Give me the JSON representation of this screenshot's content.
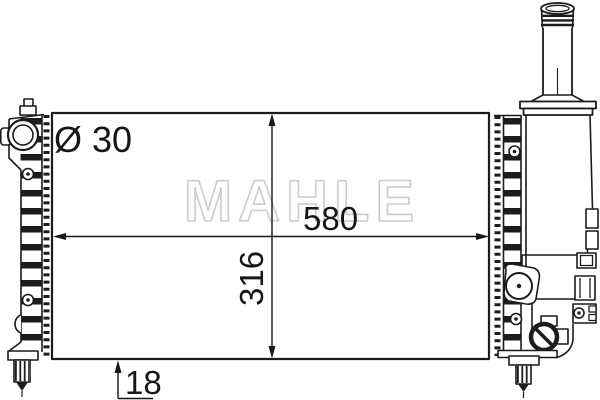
{
  "watermark": "MAHLE",
  "dimensions": {
    "port_diameter": "Ø 30",
    "core_width": "580",
    "core_height": "316",
    "core_depth": "18"
  },
  "colors": {
    "line": "#1c1c1c",
    "dimension_text": "#161616",
    "watermark_outline": "#cccccc",
    "background": "#ffffff"
  }
}
